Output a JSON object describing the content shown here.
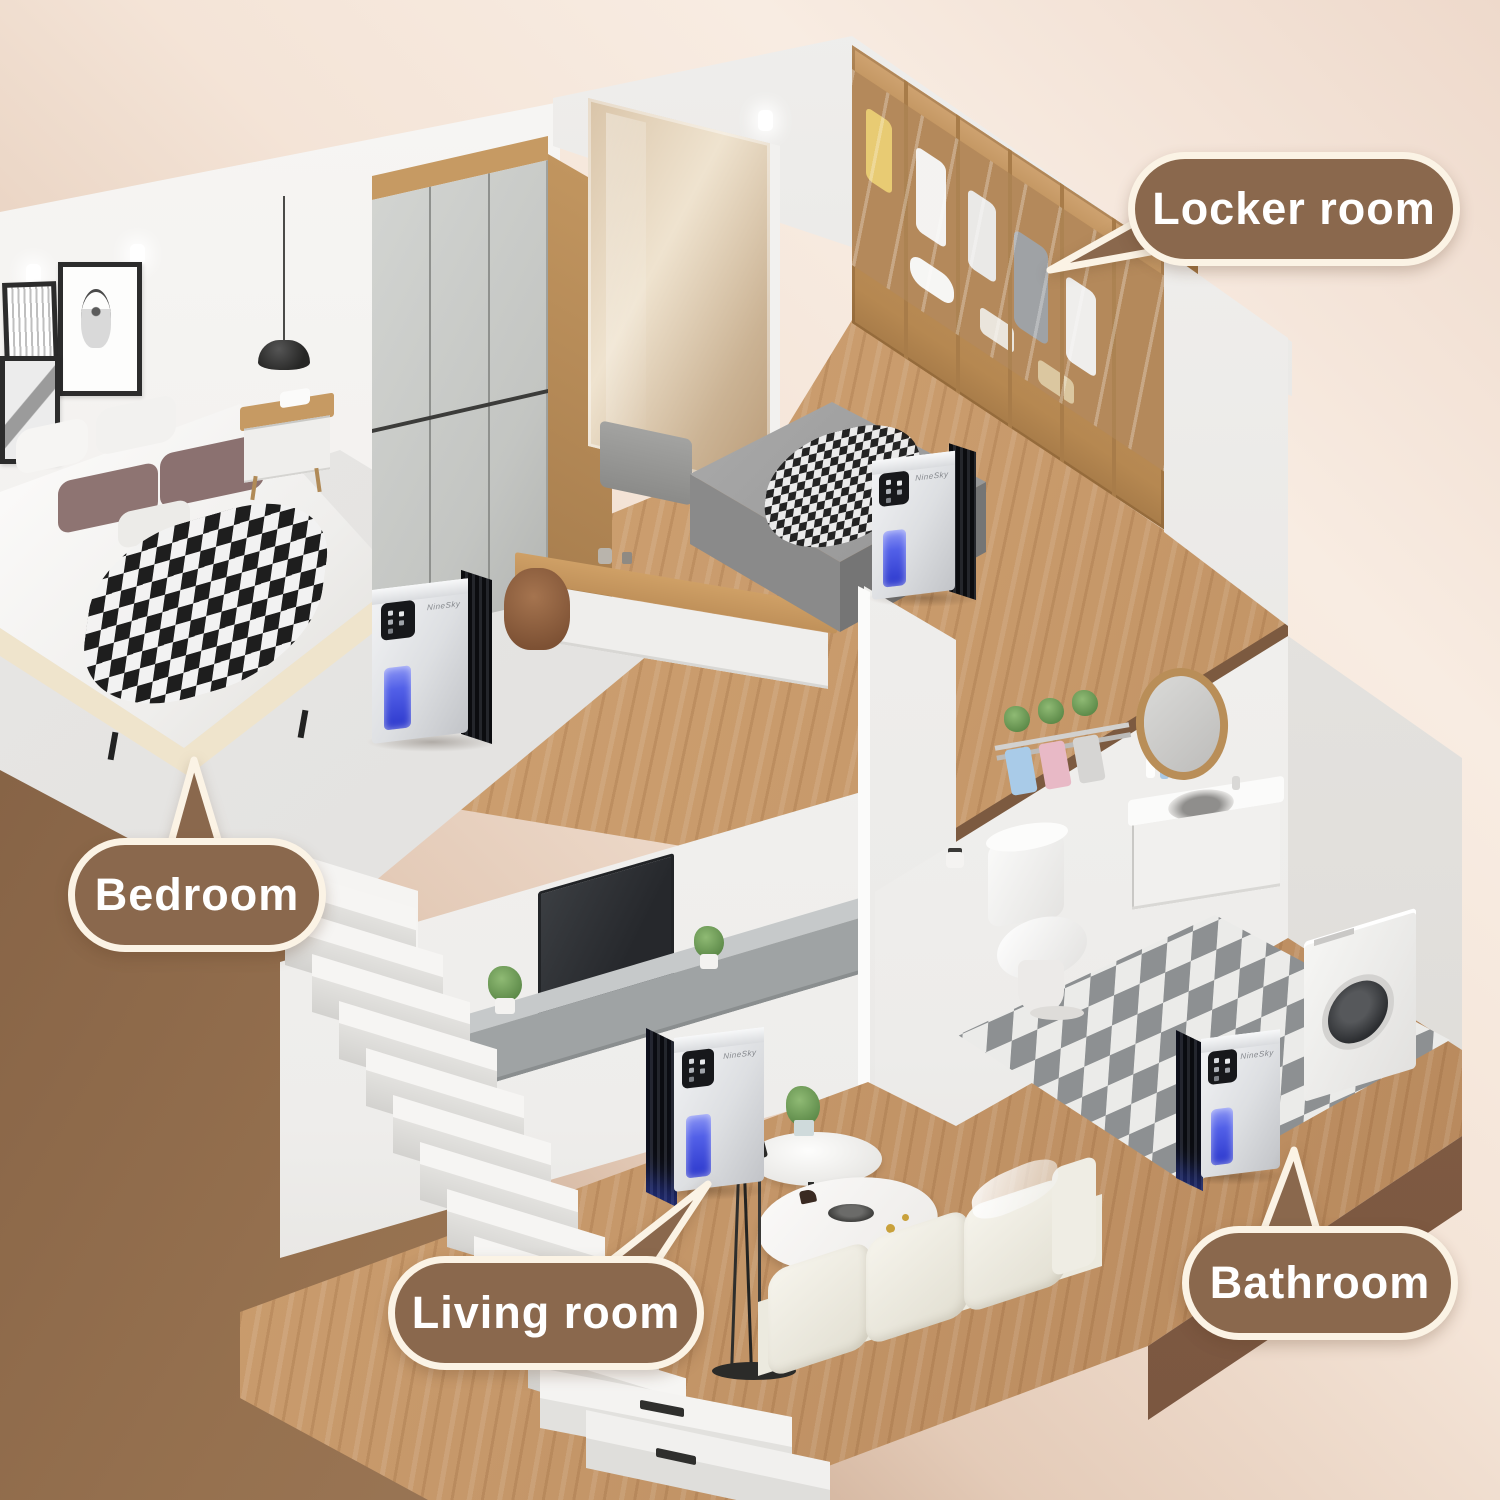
{
  "scene": {
    "description": "Isometric cutaway of a two-story home showing dehumidifier placement in four rooms",
    "rooms": [
      "Bedroom",
      "Locker room",
      "Living room",
      "Bathroom"
    ]
  },
  "labels": {
    "locker": "Locker room",
    "bedroom": "Bedroom",
    "living": "Living room",
    "bathroom": "Bathroom"
  },
  "device": {
    "brand": "NineSky"
  },
  "colors": {
    "bubble_fill": "#8a684d",
    "bubble_border": "#fbf3e5",
    "bubble_text": "#ffffff",
    "wood_floor": "#c89b6d",
    "background_cream": "#f8ece2",
    "background_brown": "#8a6648",
    "water_tank_blue": "#4350d6"
  }
}
